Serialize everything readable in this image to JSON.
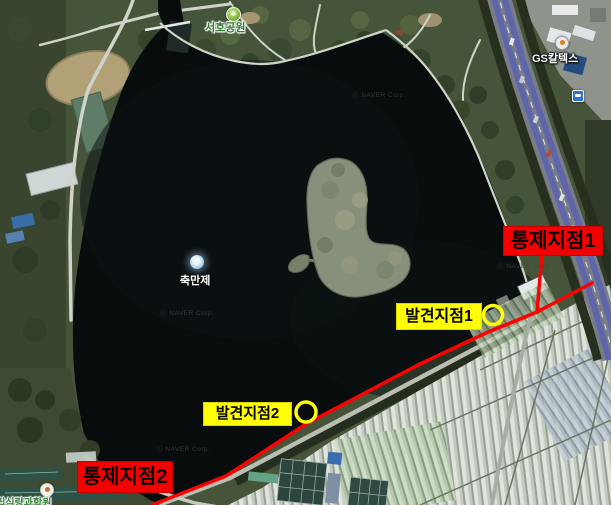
{
  "map_labels": {
    "park": "서호공원",
    "reservoir": "축만제",
    "gas_station": "GS칼텍스",
    "institute": "국립식량과학원",
    "watermark": "ⓒ NAVER Corp."
  },
  "annotations": {
    "control1": "통제지점1",
    "control2": "통제지점2",
    "discovery1": "발견지점1",
    "discovery2": "발견지점2"
  },
  "colors": {
    "control_label_bg": "#f50000",
    "discovery_label_bg": "#ffff00",
    "route_line": "#ff0000",
    "discovery_circle": "#ffff00",
    "annotation_text": "#000000",
    "water": "#080c0d"
  }
}
